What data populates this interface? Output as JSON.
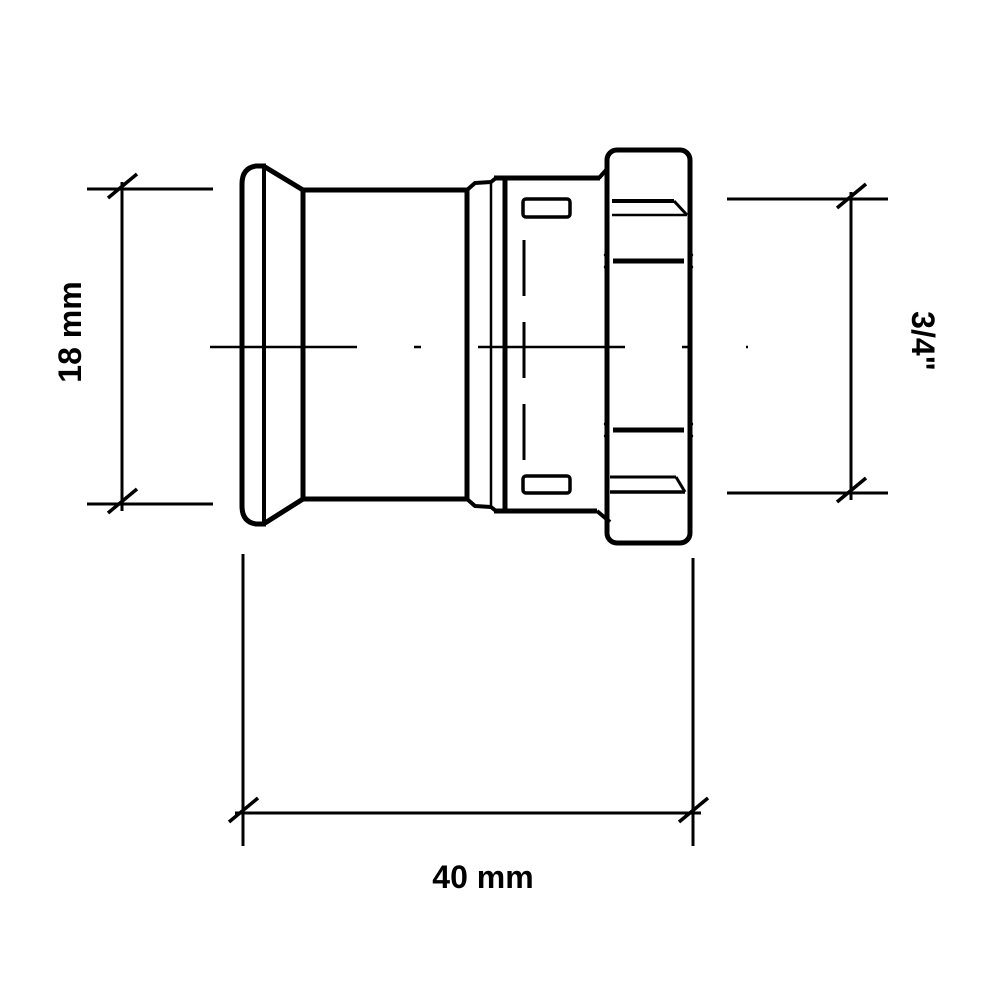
{
  "page": {
    "background_color": "#ffffff",
    "line_color": "#000000"
  },
  "drawing": {
    "kind": "pipe-fitting side view with dimensions",
    "labels": {
      "height": "18 mm",
      "thread": "3/4\"",
      "length": "40 mm"
    }
  }
}
